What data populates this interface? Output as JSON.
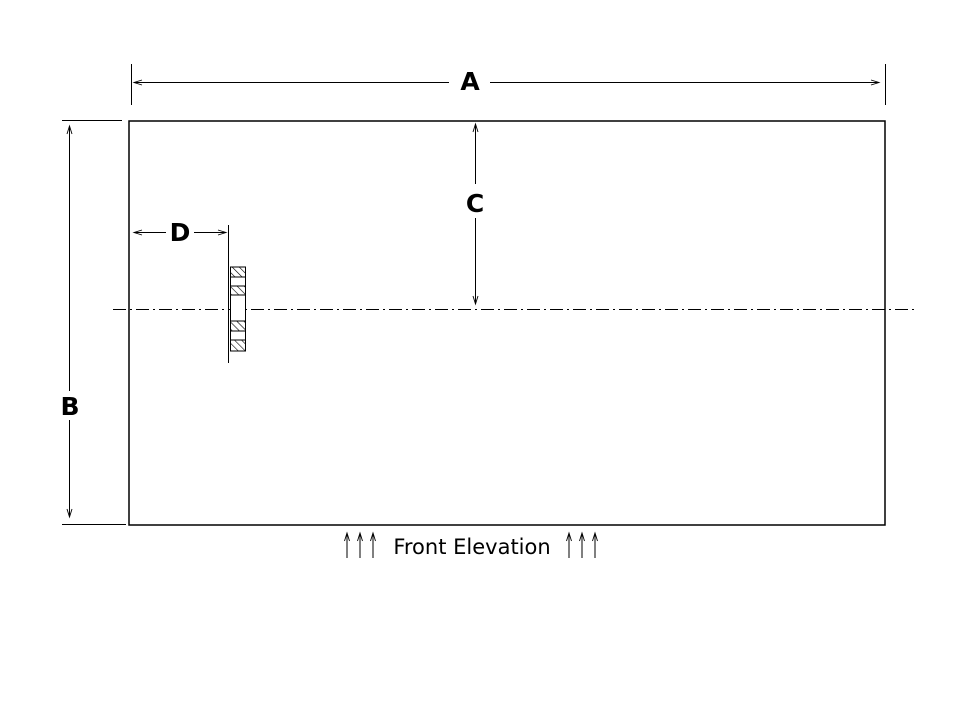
{
  "drawing": {
    "view_label": "Front Elevation",
    "dimensions": {
      "width_label": "A",
      "height_label": "B",
      "centerline_offset_label": "C",
      "stud_offset_label": "D"
    },
    "features": {
      "panel": "rectangular panel outline",
      "centerline": "horizontal dash-dot centerline",
      "stud_section": "hatched stud cross-section"
    },
    "colors": {
      "line": "#000000",
      "background": "#ffffff"
    }
  }
}
